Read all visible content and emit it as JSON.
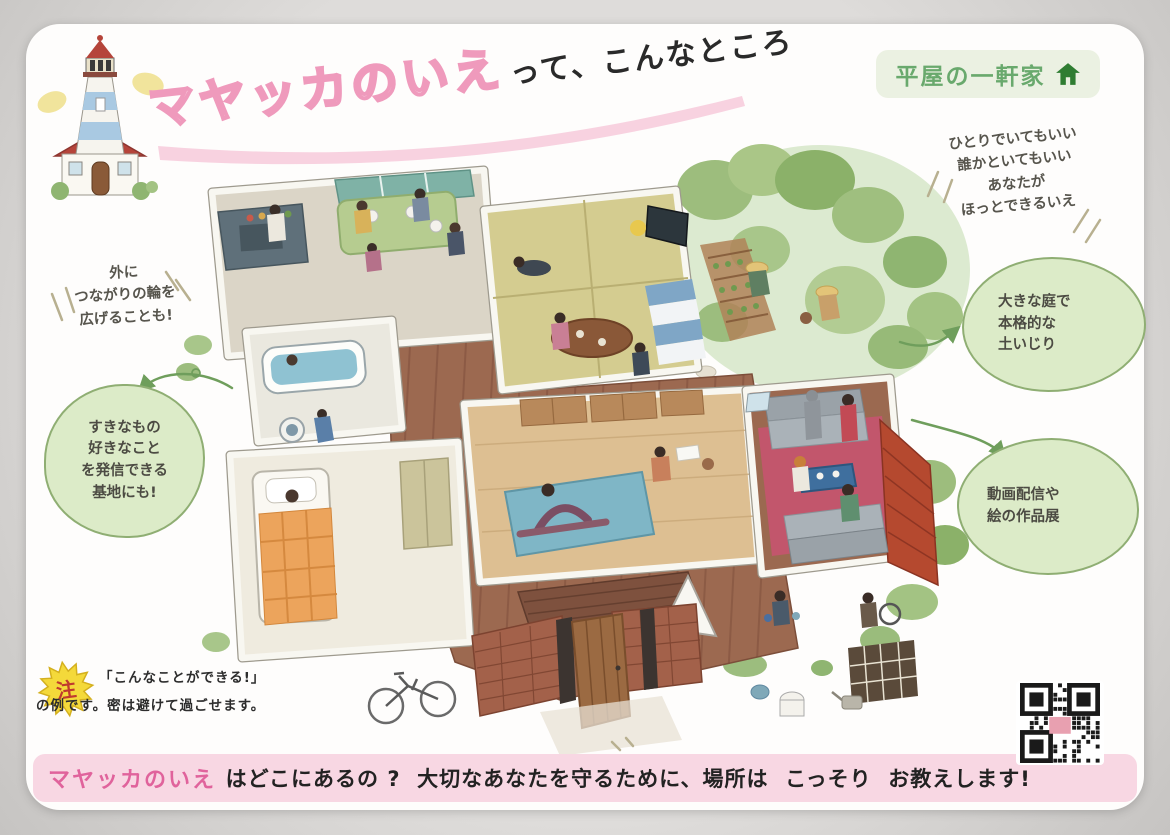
{
  "title": {
    "main": "マヤッカのいえ",
    "suffix": "って、こんなところ",
    "accent_color": "#ef9abc"
  },
  "badge": {
    "label": "平屋の一軒家",
    "icon": "home-icon",
    "text_color": "#69a96d",
    "bg_color": "#ebf1e2"
  },
  "notes": {
    "top_right": {
      "lines": [
        "ひとりでいてもいい",
        "誰かといてもいい",
        "あなたが",
        "ほっとできるいえ"
      ]
    },
    "left": {
      "lines": [
        "外に",
        "つながりの輪を",
        "広げることも!"
      ]
    }
  },
  "bubbles": [
    {
      "id": "garden-bubble",
      "lines": [
        "大きな庭で",
        "本格的な",
        "土いじり"
      ]
    },
    {
      "id": "studio-bubble",
      "lines": [
        "動画配信や",
        "絵の作品展"
      ]
    },
    {
      "id": "base-bubble",
      "lines": [
        "すきなもの",
        "好きなこと",
        "を発信できる",
        "基地にも!"
      ]
    }
  ],
  "footnote": {
    "star": "注",
    "line1": "「こんなことができる!」",
    "line2": "の例です。密は避けて過ごせます。"
  },
  "banner": {
    "highlight": "マヤッカのいえ ",
    "rest": "はどこにあるの ?  大切なあなたを守るために、場所は  こっそり  お教えします!",
    "bg_color": "#f8d7e3",
    "highlight_color": "#e0639c"
  },
  "qr": {
    "name": "qr-code"
  },
  "colors": {
    "bubble_green": "#dcebc8",
    "bubble_border": "#8fae73",
    "title_pink": "#ef9abc"
  }
}
